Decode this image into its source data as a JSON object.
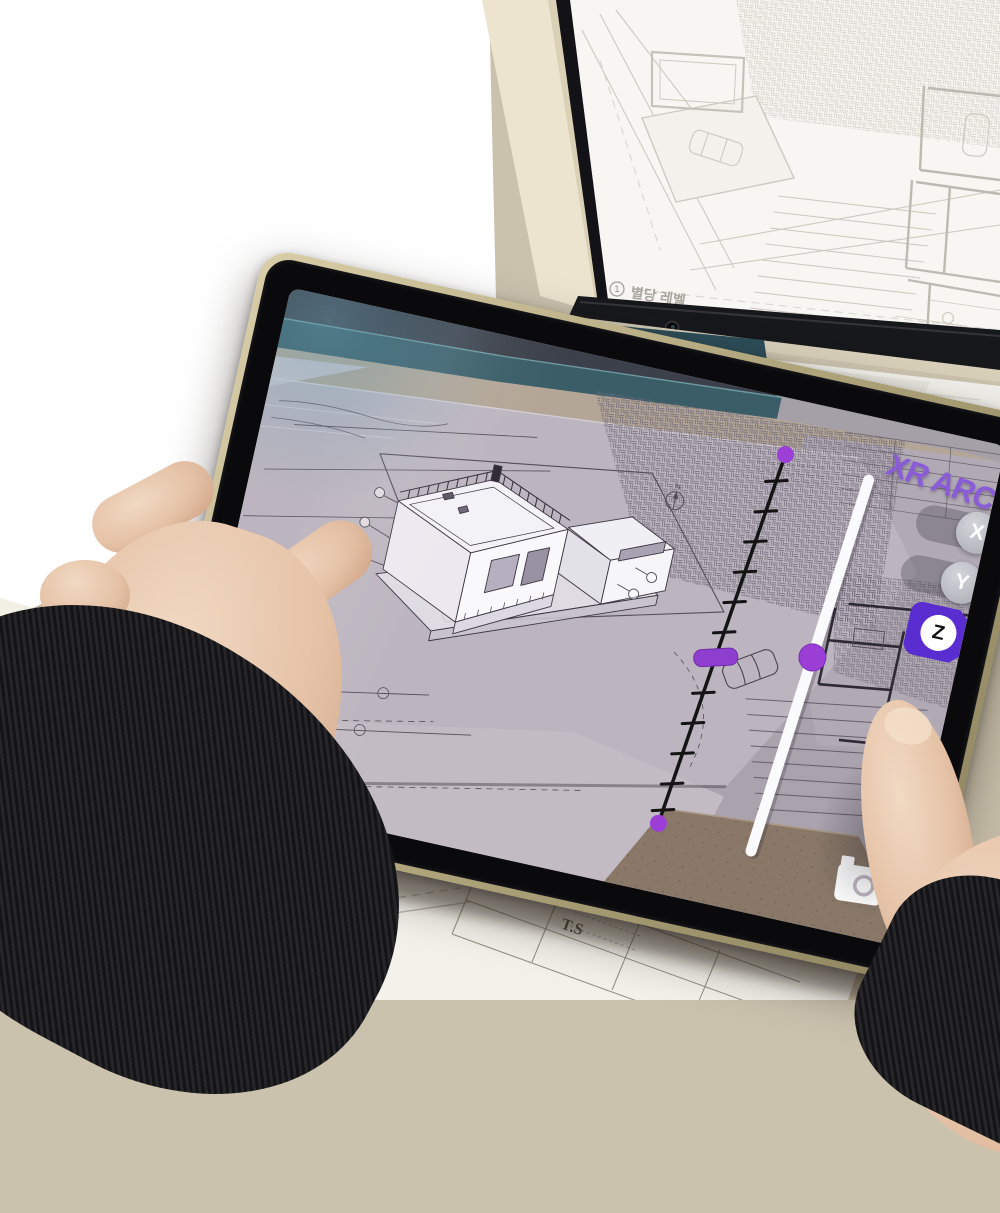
{
  "app": {
    "title": "XR ARCH",
    "refresh_icon": "↻",
    "axis_buttons": [
      {
        "label": "X"
      },
      {
        "label": "Y"
      },
      {
        "label": "Z"
      }
    ],
    "active_axis": "Z"
  },
  "ar_overlay": {
    "gizmo_y_label": "Y",
    "gizmo_x_label": "X",
    "north_label": "N",
    "dimension_labels": [
      "2700",
      "1480",
      "3400"
    ]
  },
  "monitor": {
    "plan_marker": "1",
    "plan_title": "별당 레벨",
    "plan_scale": "1 : 100"
  },
  "desk_paper": {
    "title_block_logo": "T.S"
  },
  "colors": {
    "xr_title": "#8a5cd8",
    "accent_purple": "#5a2dd0",
    "handle_purple": "#9b3fd6",
    "pink": "#f3b0d9",
    "teal_band": "#3a5d68",
    "frame_gold": "#c0b489",
    "desk": "#cbc2ae"
  }
}
